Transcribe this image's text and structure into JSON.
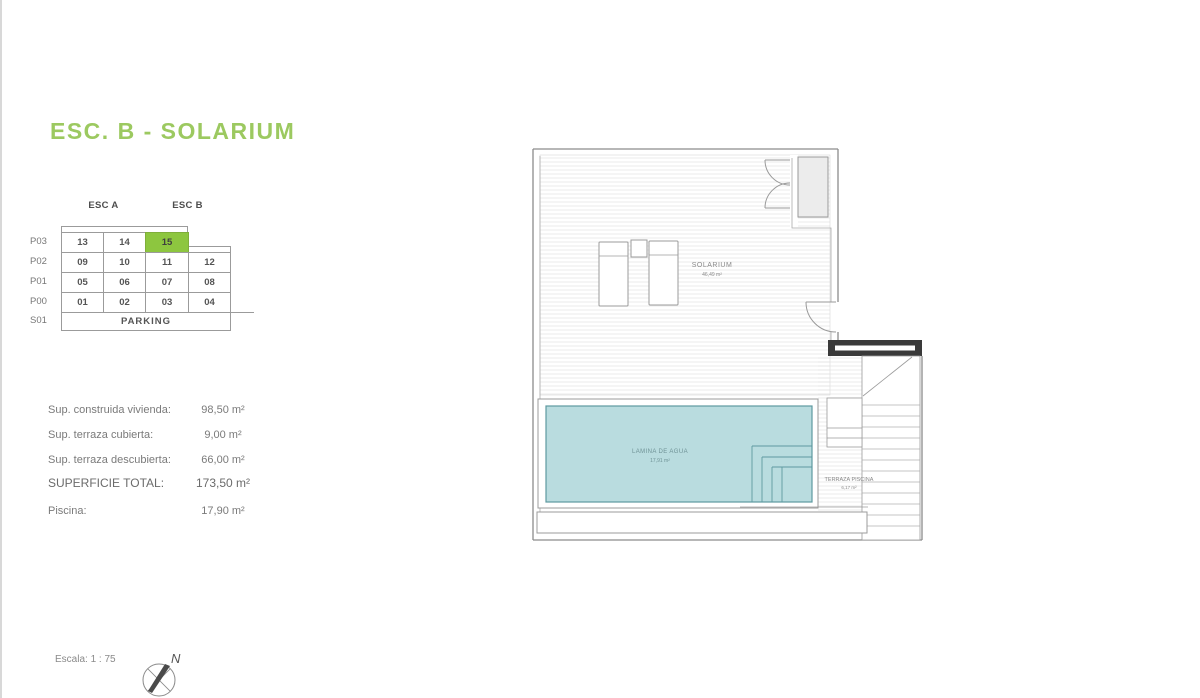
{
  "page": {
    "title": "ESC. B - SOLARIUM",
    "scale_label": "Escala: 1 : 75",
    "north_label": "N"
  },
  "unit_matrix": {
    "col_groups": [
      "ESC A",
      "ESC B"
    ],
    "row_labels": [
      "P03",
      "P02",
      "P01",
      "P00",
      "S01"
    ],
    "rows": [
      [
        "13",
        "14",
        "15"
      ],
      [
        "09",
        "10",
        "11",
        "12"
      ],
      [
        "05",
        "06",
        "07",
        "08"
      ],
      [
        "01",
        "02",
        "03",
        "04"
      ]
    ],
    "parking_label": "PARKING",
    "highlighted_unit": "15"
  },
  "areas": {
    "items": [
      {
        "label": "Sup. construida vivienda:",
        "value": "98,50 m²"
      },
      {
        "label": "Sup. terraza cubierta:",
        "value": "9,00 m²"
      },
      {
        "label": "Sup. terraza descubierta:",
        "value": "66,00 m²"
      },
      {
        "label": "SUPERFICIE TOTAL:",
        "value": "173,50 m²"
      },
      {
        "label": "Piscina:",
        "value": "17,90 m²"
      }
    ]
  },
  "floor_plan": {
    "rooms": [
      {
        "name": "SOLARIUM",
        "area": "46,49 m²"
      },
      {
        "name": "LAMINA DE AGUA",
        "area": "17,91 m²"
      },
      {
        "name": "TERRAZA PISCINA",
        "area": "6,17 m²"
      }
    ]
  },
  "colors": {
    "title_green": "#9cc960",
    "unit_highlight": "#8dc63f",
    "pool_fill": "#b9dcdf"
  }
}
